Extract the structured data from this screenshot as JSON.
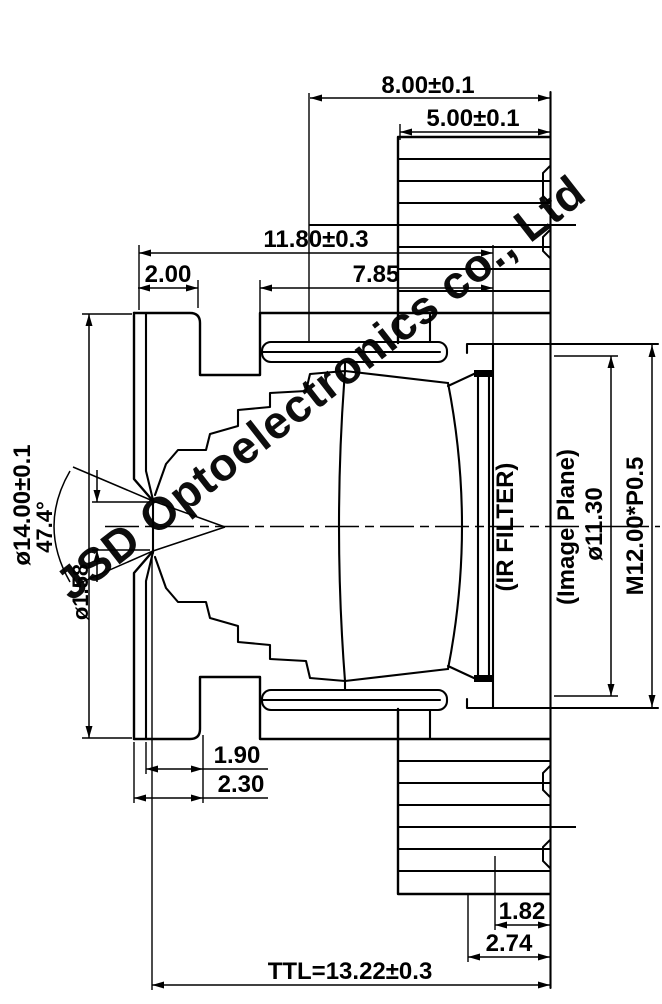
{
  "drawing": {
    "title": "M12 board lens cross-section drawing",
    "watermark": "JSD Optoelectronics co., Ltd",
    "dims": {
      "d800": "8.00±0.1",
      "d500": "5.00±0.1",
      "d1180": "11.80±0.3",
      "d200": "2.00",
      "d785": "7.85",
      "d14": "ø14.00±0.1",
      "d474": "47.4°",
      "d158": "ø1.58",
      "d190": "1.90",
      "d230": "2.30",
      "d182": "1.82",
      "d274": "2.74",
      "dttl": "TTL=13.22±0.3",
      "d1130": "ø11.30",
      "dm12": "M12.00*P0.5"
    },
    "labels": {
      "ir_filter": "(IR FILTER)",
      "image_plane": "(Image Plane)"
    }
  }
}
